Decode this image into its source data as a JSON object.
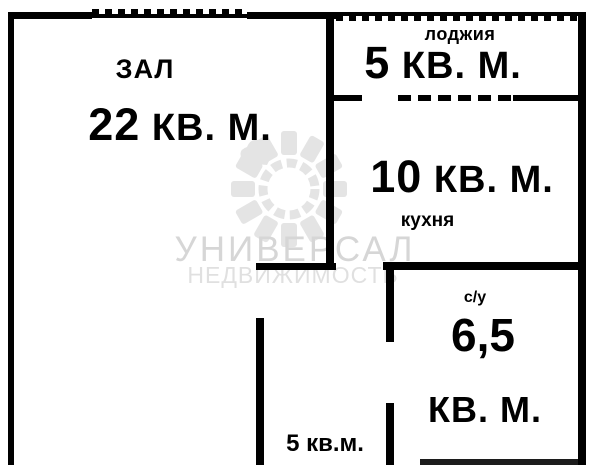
{
  "plan_title": "apartment-floor-plan",
  "watermark": {
    "brand": "УНИВЕРСАЛ",
    "subtitle": "НЕДВИЖИМОСТЬ"
  },
  "rooms": {
    "hall": {
      "label": "ЗАЛ",
      "area_value": "22",
      "area_unit": "КВ. М."
    },
    "loggia": {
      "label": "лоджия",
      "area_value": "5",
      "area_unit": "КВ. М."
    },
    "kitchen": {
      "label": "кухня",
      "area_value": "10",
      "area_unit": "КВ. М."
    },
    "bathroom": {
      "label": "с/у",
      "area_value": "6,5",
      "area_unit": "КВ. М."
    },
    "hallway": {
      "area": "5 кв.м."
    }
  },
  "colors": {
    "wall": "#000000",
    "background": "#ffffff",
    "watermark_text": "#d6d6d6",
    "watermark_logo": "#e4e4e4"
  }
}
